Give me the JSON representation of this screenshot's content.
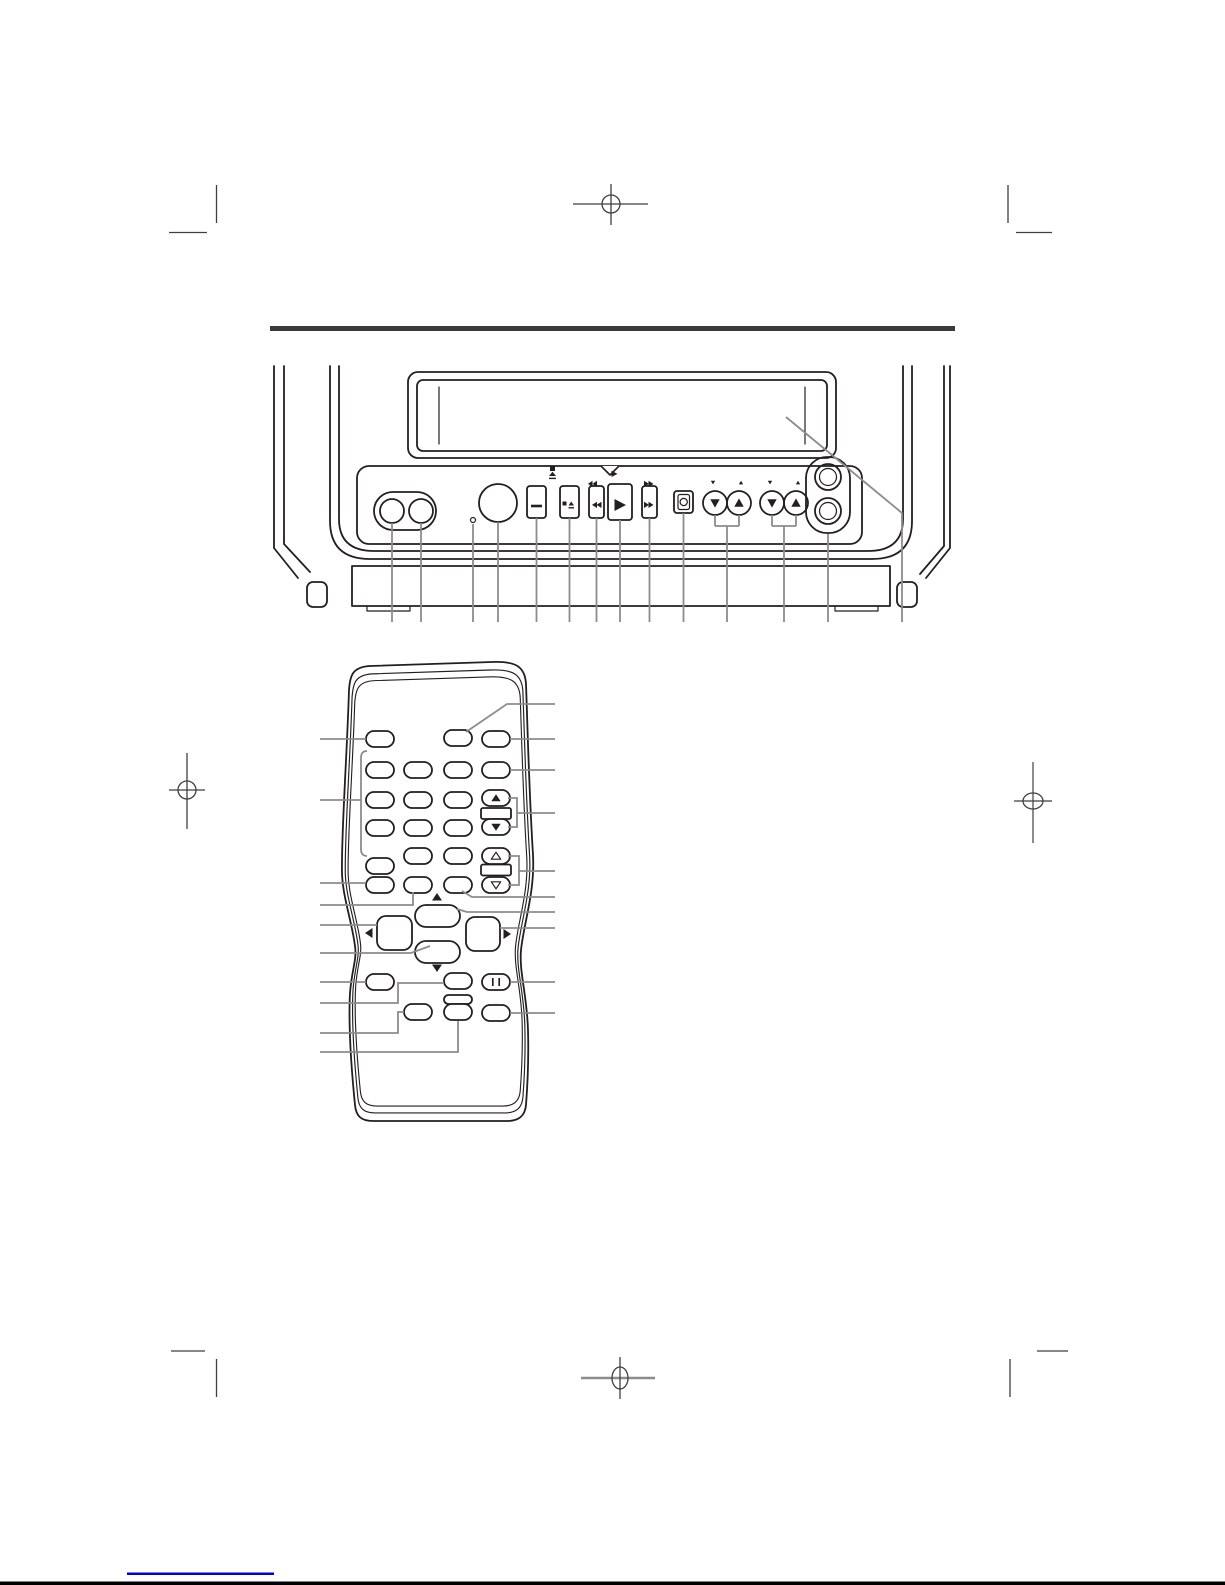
{
  "document": {
    "kind": "manual-page-diagram",
    "page_background": "#ffffff",
    "artwork_line_color": "#231f20",
    "callout_line_color": "#8c8c8c",
    "divider_rule_color": "#3a3a3a",
    "registration_mark_color": "#3f3f3f",
    "footer_link_color": "#0000d4",
    "footer_bar_color": "#000000"
  },
  "front_panel_diagram": {
    "device_icon": "tv-vcr-front-panel",
    "cassette_slot_icon": "cassette-door",
    "controls": [
      {
        "name": "av-jack-left",
        "icon": "round-jack"
      },
      {
        "name": "av-jack-right",
        "icon": "round-jack"
      },
      {
        "name": "sensor-dot",
        "icon": "small-dot"
      },
      {
        "name": "power-button",
        "icon": "large-circle"
      },
      {
        "name": "bar-button",
        "glyph": "—"
      },
      {
        "name": "stop-eject-button",
        "glyph": "■⏏"
      },
      {
        "name": "rewind-button",
        "glyph": "◀◀"
      },
      {
        "name": "play-button",
        "glyph": "▶"
      },
      {
        "name": "fast-forward-button",
        "glyph": "▶▶"
      },
      {
        "name": "record-button",
        "icon": "circle-in-square"
      },
      {
        "name": "channel-down-button",
        "glyph": "▼"
      },
      {
        "name": "channel-up-button",
        "glyph": "▲"
      },
      {
        "name": "volume-down-button",
        "glyph": "▼"
      },
      {
        "name": "volume-up-button",
        "glyph": "▲"
      },
      {
        "name": "knob-upper",
        "icon": "round-knob"
      },
      {
        "name": "knob-lower",
        "icon": "round-knob"
      }
    ],
    "callout_count": 14
  },
  "remote_diagram": {
    "device_icon": "remote-control",
    "top_row_button_count": 3,
    "keypad_button_count": 16,
    "volume_rocker": {
      "up_glyph": "▲",
      "down_glyph": "▼"
    },
    "channel_rocker": {
      "up_glyph": "△",
      "down_glyph": "▽"
    },
    "dpad": {
      "up_glyph": "▲",
      "down_glyph": "▼",
      "left_glyph": "◀",
      "right_glyph": "▶"
    },
    "pause_glyph": "❙❙",
    "lower_button_count": 7,
    "left_callout_count": 10,
    "right_callout_count": 10
  }
}
